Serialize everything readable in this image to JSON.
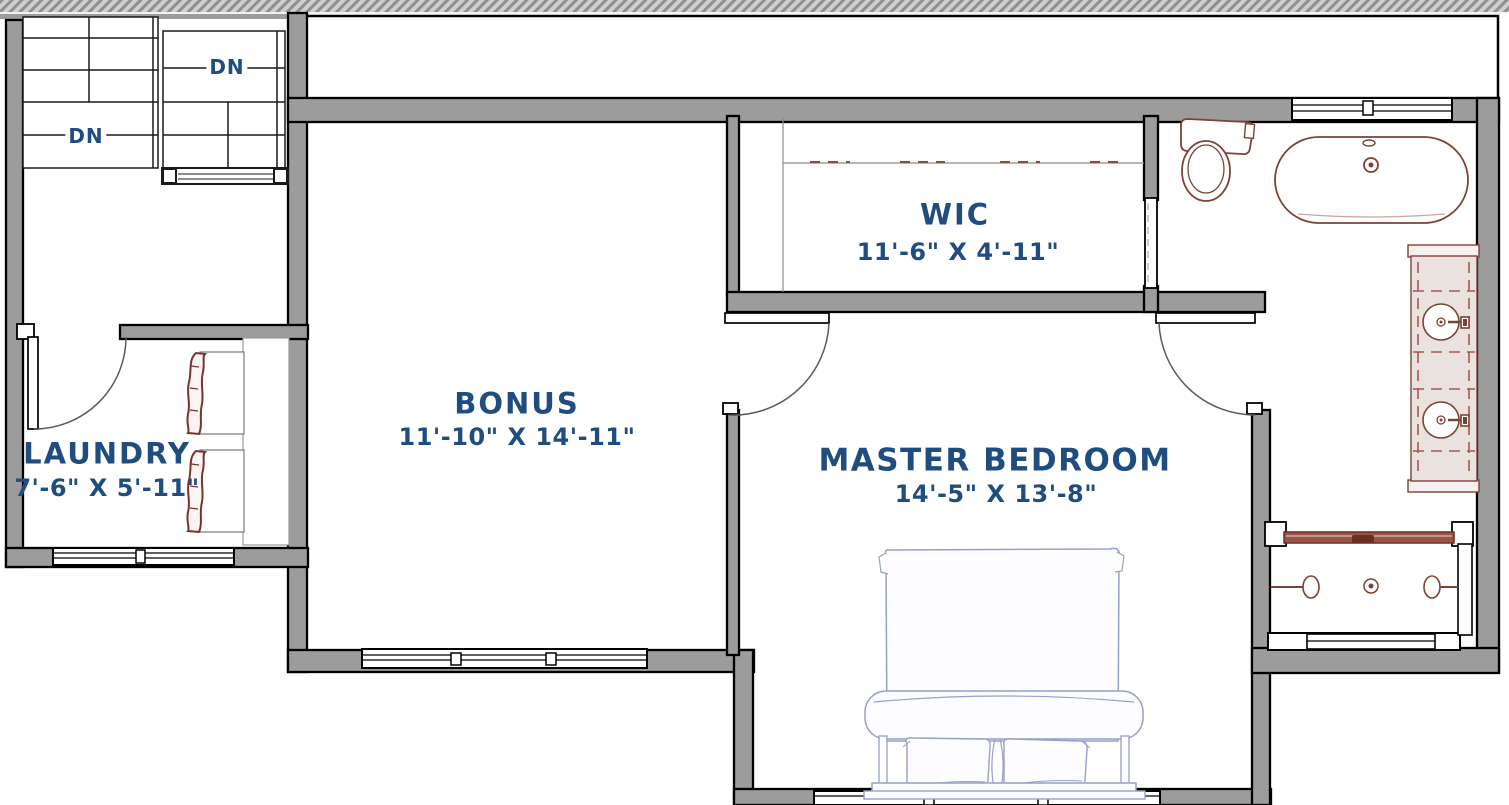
{
  "plan": {
    "stairs": [
      {
        "label": "DN"
      },
      {
        "label": "DN"
      }
    ],
    "rooms": [
      {
        "name": "LAUNDRY",
        "dimensions": "7'-6\" X 5'-11\""
      },
      {
        "name": "BONUS",
        "dimensions": "11'-10\" X 14'-11\""
      },
      {
        "name": "WIC",
        "dimensions": "11'-6\" X 4'-11\""
      },
      {
        "name": "MASTER BEDROOM",
        "dimensions": "14'-5\" X 13'-8\""
      }
    ],
    "fixtures": [
      "toilet",
      "bathtub",
      "double-vanity-sinks",
      "walk-in-shower",
      "washer",
      "dryer",
      "bed"
    ],
    "colors": {
      "label_text": "#1f4d80",
      "wall_fill": "#9c9c9c",
      "fixture_stroke": "#7b4336",
      "furniture_stroke": "#97a0c6",
      "shower_glass": "#9c5247"
    }
  }
}
